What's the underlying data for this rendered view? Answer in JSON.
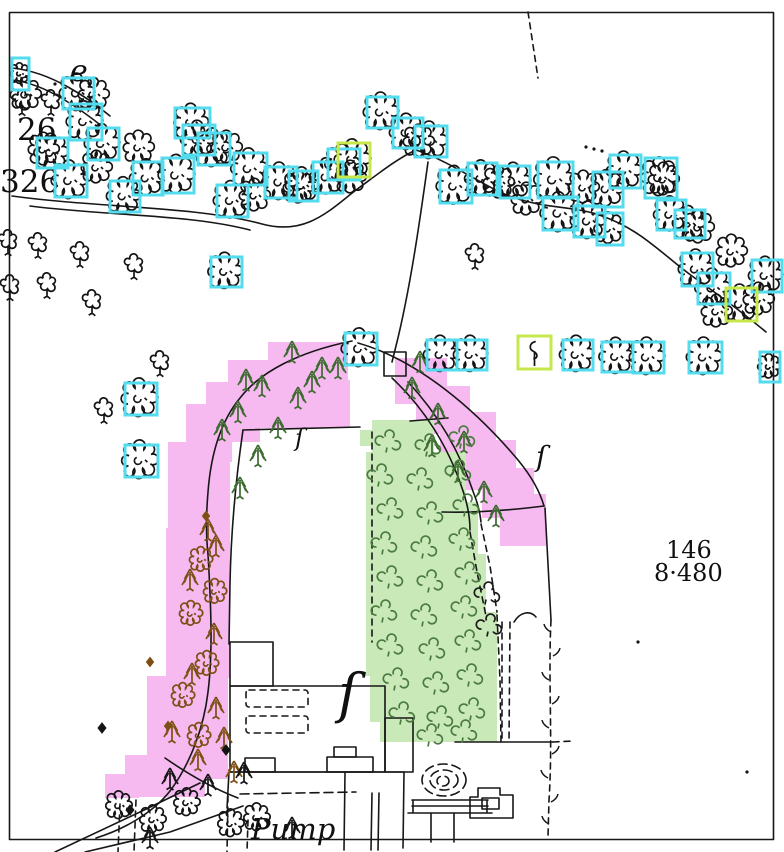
{
  "map": {
    "description": "scanned historical map with tree annotation overlays",
    "labels": [
      {
        "id": "letter-e",
        "text": "e",
        "x": 70,
        "y": 81,
        "size": 30,
        "style": "italic"
      },
      {
        "id": "number-26",
        "text": "26",
        "x": 17,
        "y": 140,
        "size": 31,
        "style": "plain"
      },
      {
        "id": "number-326",
        "text": "326",
        "x": 0,
        "y": 192,
        "size": 31,
        "style": "plain"
      },
      {
        "id": "parcel-146",
        "text": "146",
        "x": 666,
        "y": 558,
        "size": 24,
        "style": "plain"
      },
      {
        "id": "area-8-480",
        "text": "8·480",
        "x": 654,
        "y": 581,
        "size": 24,
        "style": "plain"
      },
      {
        "id": "pump",
        "text": "Pump",
        "x": 251,
        "y": 839,
        "size": 29,
        "style": "italic"
      }
    ],
    "brace_symbols": [
      {
        "glyph": "ſ",
        "x": 338,
        "y": 712,
        "size": 54
      },
      {
        "glyph": "ſ",
        "x": 536,
        "y": 466,
        "size": 28
      },
      {
        "glyph": "ſ",
        "x": 295,
        "y": 446,
        "size": 24
      }
    ],
    "annotations": {
      "cyan_color": "#53dcee",
      "yellow_color": "#c6e84c",
      "box_stroke_width": 3,
      "cyan_boxes": [
        [
          12,
          58,
          17,
          32
        ],
        [
          63,
          78,
          31,
          31
        ],
        [
          70,
          104,
          32,
          36
        ],
        [
          88,
          128,
          31,
          32
        ],
        [
          37,
          138,
          31,
          30
        ],
        [
          55,
          165,
          32,
          32
        ],
        [
          110,
          181,
          30,
          31
        ],
        [
          133,
          162,
          30,
          33
        ],
        [
          162,
          158,
          32,
          35
        ],
        [
          175,
          108,
          35,
          30
        ],
        [
          183,
          125,
          32,
          30
        ],
        [
          198,
          133,
          32,
          32
        ],
        [
          217,
          185,
          31,
          32
        ],
        [
          234,
          153,
          33,
          32
        ],
        [
          265,
          167,
          32,
          31
        ],
        [
          289,
          171,
          29,
          30
        ],
        [
          313,
          162,
          30,
          31
        ],
        [
          328,
          149,
          32,
          31
        ],
        [
          367,
          97,
          31,
          31
        ],
        [
          393,
          118,
          30,
          30
        ],
        [
          415,
          126,
          32,
          31
        ],
        [
          440,
          170,
          32,
          33
        ],
        [
          468,
          163,
          29,
          32
        ],
        [
          500,
          166,
          30,
          32
        ],
        [
          538,
          162,
          35,
          36
        ],
        [
          543,
          197,
          35,
          33
        ],
        [
          574,
          206,
          31,
          31
        ],
        [
          593,
          172,
          30,
          35
        ],
        [
          597,
          213,
          26,
          32
        ],
        [
          610,
          155,
          31,
          33
        ],
        [
          645,
          158,
          32,
          40
        ],
        [
          657,
          200,
          29,
          30
        ],
        [
          675,
          210,
          30,
          28
        ],
        [
          682,
          253,
          31,
          33
        ],
        [
          698,
          273,
          32,
          31
        ],
        [
          752,
          260,
          30,
          32
        ],
        [
          760,
          352,
          20,
          30
        ],
        [
          211,
          257,
          31,
          30
        ],
        [
          125,
          383,
          32,
          32
        ],
        [
          125,
          445,
          33,
          32
        ],
        [
          345,
          333,
          32,
          32
        ],
        [
          427,
          340,
          30,
          30
        ],
        [
          457,
          340,
          30,
          30
        ],
        [
          563,
          340,
          30,
          30
        ],
        [
          602,
          342,
          31,
          30
        ],
        [
          633,
          342,
          31,
          31
        ],
        [
          689,
          342,
          33,
          31
        ]
      ],
      "yellow_boxes": [
        {
          "rect": [
            338,
            143,
            32,
            34
          ],
          "glyph": "broadleaf"
        },
        {
          "rect": [
            726,
            288,
            31,
            33
          ],
          "glyph": "broadleaf"
        },
        {
          "rect": [
            518,
            336,
            33,
            33
          ],
          "glyph": "baretree"
        }
      ]
    },
    "regions": {
      "pink": {
        "color": "#f6b9f0",
        "cells": [
          [
            268,
            342,
            80,
            38
          ],
          [
            228,
            360,
            74,
            58
          ],
          [
            230,
            380,
            120,
            48
          ],
          [
            206,
            382,
            54,
            60
          ],
          [
            186,
            404,
            46,
            58
          ],
          [
            168,
            442,
            62,
            88
          ],
          [
            166,
            528,
            64,
            150
          ],
          [
            147,
            676,
            81,
            86
          ],
          [
            125,
            755,
            80,
            42
          ],
          [
            105,
            774,
            34,
            24
          ],
          [
            200,
            755,
            28,
            24
          ],
          [
            395,
            358,
            52,
            46
          ],
          [
            416,
            386,
            54,
            48
          ],
          [
            440,
            412,
            56,
            48
          ],
          [
            462,
            440,
            54,
            50
          ],
          [
            482,
            468,
            52,
            50
          ],
          [
            500,
            494,
            46,
            52
          ]
        ]
      },
      "green": {
        "color": "#c9e9b8",
        "cells": [
          [
            372,
            420,
            62,
            32
          ],
          [
            366,
            452,
            100,
            50
          ],
          [
            366,
            502,
            112,
            52
          ],
          [
            366,
            554,
            120,
            58
          ],
          [
            366,
            612,
            131,
            64
          ],
          [
            370,
            676,
            127,
            46
          ],
          [
            380,
            722,
            117,
            20
          ],
          [
            360,
            430,
            12,
            16
          ]
        ]
      }
    },
    "tree_groups": [
      {
        "symbol": "broadleaf",
        "color": "#141414",
        "scale": 1.0,
        "points": [
          [
            45,
            150
          ],
          [
            98,
            168
          ],
          [
            140,
            148
          ],
          [
            228,
            148
          ],
          [
            256,
            196
          ],
          [
            300,
            188
          ],
          [
            352,
            178
          ],
          [
            420,
            142
          ],
          [
            500,
            183
          ],
          [
            528,
            200
          ],
          [
            585,
            188
          ],
          [
            665,
            180
          ],
          [
            700,
            228
          ],
          [
            733,
            252
          ],
          [
            718,
            312
          ],
          [
            760,
            300
          ],
          [
            27,
            95
          ],
          [
            95,
            95
          ]
        ]
      },
      {
        "symbol": "smalltree",
        "color": "#141414",
        "scale": 1.1,
        "points": [
          [
            22,
            102
          ],
          [
            51,
            102
          ],
          [
            8,
            242
          ],
          [
            38,
            245
          ],
          [
            80,
            254
          ],
          [
            47,
            285
          ],
          [
            92,
            302
          ],
          [
            134,
            266
          ],
          [
            10,
            287
          ],
          [
            160,
            363
          ],
          [
            104,
            410
          ],
          [
            475,
            256
          ]
        ]
      },
      {
        "symbol": "conifer",
        "color": "#3c6a2e",
        "scale": 1.0,
        "points": [
          [
            292,
            352
          ],
          [
            322,
            368
          ],
          [
            262,
            386
          ],
          [
            298,
            398
          ],
          [
            238,
            412
          ],
          [
            278,
            428
          ],
          [
            258,
            456
          ],
          [
            240,
            488
          ],
          [
            312,
            382
          ],
          [
            338,
            368
          ],
          [
            412,
            388
          ],
          [
            438,
            414
          ],
          [
            464,
            442
          ],
          [
            432,
            446
          ],
          [
            458,
            472
          ],
          [
            484,
            492
          ],
          [
            420,
            362
          ],
          [
            496,
            516
          ],
          [
            222,
            430
          ],
          [
            246,
            380
          ]
        ]
      },
      {
        "symbol": "conifer",
        "color": "#7d4f15",
        "scale": 1.0,
        "points": [
          [
            216,
            546
          ],
          [
            190,
            580
          ],
          [
            214,
            634
          ],
          [
            192,
            674
          ],
          [
            216,
            708
          ],
          [
            198,
            760
          ],
          [
            224,
            738
          ],
          [
            172,
            732
          ],
          [
            208,
            530
          ],
          [
            234,
            772
          ]
        ]
      },
      {
        "symbol": "broadleaf",
        "color": "#7d4f15",
        "scale": 0.75,
        "points": [
          [
            202,
            560
          ],
          [
            192,
            614
          ],
          [
            208,
            664
          ],
          [
            184,
            696
          ],
          [
            200,
            736
          ],
          [
            216,
            592
          ]
        ]
      },
      {
        "symbol": "orchard",
        "color": "#4a7a40",
        "scale": 1.0,
        "points": [
          [
            388,
            444
          ],
          [
            428,
            448
          ],
          [
            462,
            440
          ],
          [
            380,
            478
          ],
          [
            420,
            482
          ],
          [
            458,
            474
          ],
          [
            390,
            512
          ],
          [
            430,
            516
          ],
          [
            466,
            508
          ],
          [
            384,
            546
          ],
          [
            424,
            550
          ],
          [
            462,
            542
          ],
          [
            390,
            580
          ],
          [
            430,
            584
          ],
          [
            468,
            576
          ],
          [
            384,
            614
          ],
          [
            424,
            618
          ],
          [
            464,
            610
          ],
          [
            390,
            648
          ],
          [
            432,
            652
          ],
          [
            468,
            644
          ],
          [
            396,
            682
          ],
          [
            436,
            686
          ],
          [
            470,
            678
          ],
          [
            402,
            716
          ],
          [
            440,
            720
          ],
          [
            472,
            712
          ],
          [
            430,
            738
          ],
          [
            464,
            734
          ]
        ]
      },
      {
        "symbol": "orchard",
        "color": "#1a1a1a",
        "scale": 1.0,
        "points": [
          [
            487,
            596
          ],
          [
            489,
            628
          ]
        ]
      },
      {
        "symbol": "broadleaf",
        "color": "#141414",
        "scale": 0.85,
        "points": [
          [
            120,
            806
          ],
          [
            154,
            820
          ],
          [
            188,
            803
          ],
          [
            232,
            824
          ],
          [
            258,
            818
          ]
        ]
      },
      {
        "symbol": "conifer",
        "color": "#141414",
        "scale": 1.0,
        "points": [
          [
            170,
            779
          ],
          [
            208,
            785
          ],
          [
            244,
            773
          ],
          [
            150,
            838
          ],
          [
            292,
            828
          ]
        ]
      },
      {
        "symbol": "diamond",
        "color": "#141414",
        "fill": true,
        "scale": 1.0,
        "points": [
          [
            102,
            728
          ],
          [
            130,
            810
          ],
          [
            226,
            750
          ]
        ]
      },
      {
        "symbol": "diamond",
        "color": "#7d4f15",
        "fill": true,
        "scale": 0.9,
        "points": [
          [
            168,
            726
          ],
          [
            150,
            662
          ],
          [
            206,
            516
          ]
        ]
      }
    ],
    "stipple_dots": [
      [
        586,
        147
      ],
      [
        594,
        149
      ],
      [
        602,
        151
      ],
      [
        575,
        210
      ],
      [
        584,
        212
      ],
      [
        593,
        214
      ],
      [
        638,
        642
      ],
      [
        747,
        772
      ],
      [
        55,
        84
      ]
    ],
    "hedge_ticks": [
      [
        551,
        632
      ],
      [
        553,
        656
      ],
      [
        549,
        680
      ],
      [
        552,
        704
      ],
      [
        549,
        728
      ],
      [
        552,
        754
      ],
      [
        548,
        778
      ],
      [
        551,
        802
      ],
      [
        549,
        824
      ]
    ]
  }
}
